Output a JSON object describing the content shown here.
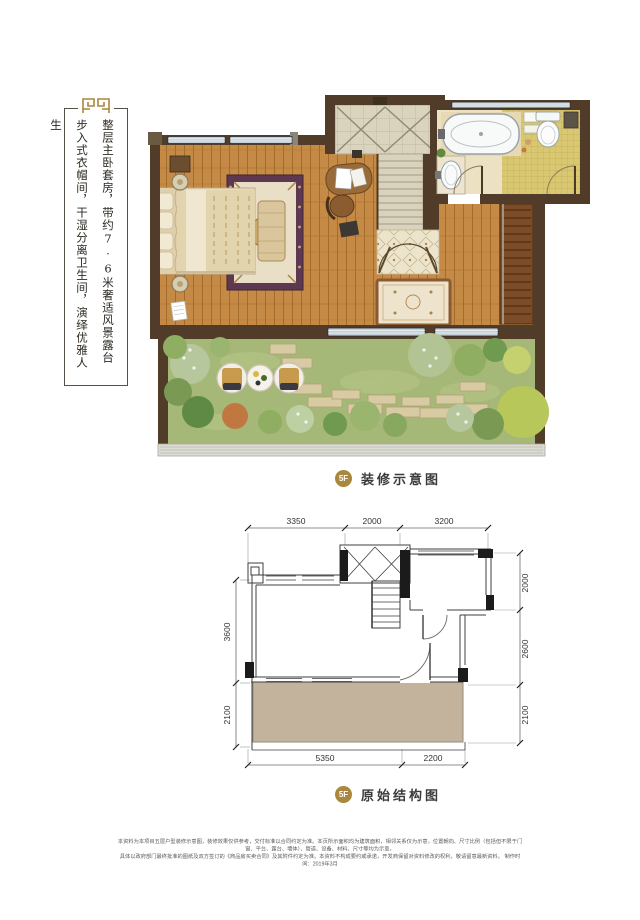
{
  "colors": {
    "gold": "#a9873e",
    "wall_brown": "#503c28",
    "terrace_tan": "#c4b39c"
  },
  "intro": {
    "line1": "整层主卧套房，带约7·6米奢适风景露台",
    "line2": "步入式衣帽间，干湿分离卫生间，演绎优雅人生"
  },
  "deco_label": {
    "badge": "5F",
    "text": "装修示意图"
  },
  "struct_label": {
    "badge": "5F",
    "text": "原始结构图"
  },
  "struct_dims": {
    "top": [
      "3350",
      "2000",
      "3200"
    ],
    "right": [
      "2000",
      "2600",
      "2100"
    ],
    "left": [
      "3600",
      "2100"
    ],
    "bottom": [
      "5350",
      "2200"
    ]
  },
  "disclaimer": {
    "line1": "本资料为本项目五层户型装修示意图，装修效果仅供参考，交付标准以合同约定为准。本页所示面积均为建筑面积，相邻关系仅为示意，位置朝向、尺寸比例（包括但不限于门窗、平台、露台、墙体）、管道、设备、材料、尺寸等均为示意，",
    "line2": "具体以政府部门最终批准的图纸及双方签订的《商品房买卖合同》及其附件约定为准。本资料不构成要约或承诺，开发商保留对资料修改的权利，敬请留意最新资料。  制作时间：2019年3月"
  }
}
